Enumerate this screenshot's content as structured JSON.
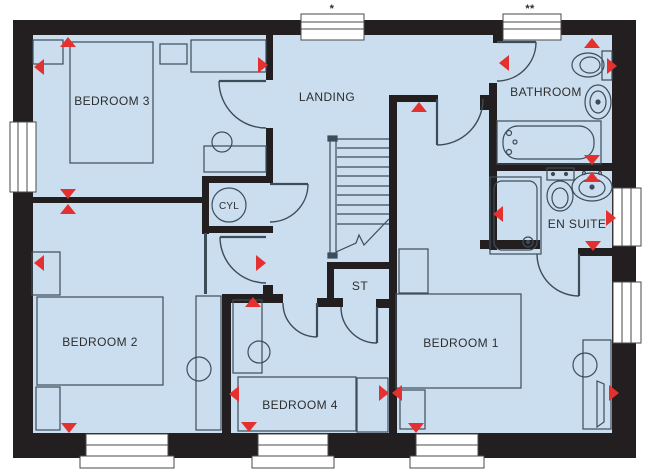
{
  "plan": {
    "title": "First floor plan",
    "rooms": {
      "bedroom3": "BEDROOM 3",
      "landing": "LANDING",
      "bathroom": "BATHROOM",
      "cyl": "CYL",
      "ensuite": "EN SUITE",
      "bedroom2": "BEDROOM 2",
      "st": "ST",
      "bedroom4": "BEDROOM 4",
      "bedroom1": "BEDROOM 1"
    },
    "window_notes": {
      "landing": "*",
      "bathroom": "**"
    },
    "colors": {
      "floor": "#cadeef",
      "wall": "#231f20",
      "marker": "#e53030",
      "line": "#3d4c59",
      "label": "#2d2d2d",
      "window_frame": "#4a4a4a"
    },
    "markers": [
      {
        "dir": "up",
        "x": 68,
        "y": 42
      },
      {
        "dir": "left",
        "x": 39,
        "y": 67
      },
      {
        "dir": "right",
        "x": 263,
        "y": 65
      },
      {
        "dir": "down",
        "x": 68,
        "y": 194
      },
      {
        "dir": "up",
        "x": 68,
        "y": 209
      },
      {
        "dir": "up",
        "x": 419,
        "y": 107
      },
      {
        "dir": "left",
        "x": 504,
        "y": 63
      },
      {
        "dir": "up",
        "x": 592,
        "y": 43
      },
      {
        "dir": "right",
        "x": 612,
        "y": 66
      },
      {
        "dir": "down",
        "x": 592,
        "y": 160
      },
      {
        "dir": "up",
        "x": 592,
        "y": 177
      },
      {
        "dir": "left",
        "x": 498,
        "y": 214
      },
      {
        "dir": "right",
        "x": 611,
        "y": 218
      },
      {
        "dir": "down",
        "x": 593,
        "y": 246
      },
      {
        "dir": "right",
        "x": 261,
        "y": 263
      },
      {
        "dir": "up",
        "x": 253,
        "y": 302
      },
      {
        "dir": "left",
        "x": 234,
        "y": 394
      },
      {
        "dir": "right",
        "x": 384,
        "y": 393
      },
      {
        "dir": "left",
        "x": 397,
        "y": 393
      },
      {
        "dir": "left",
        "x": 39,
        "y": 263
      },
      {
        "dir": "down",
        "x": 69,
        "y": 428
      },
      {
        "dir": "down",
        "x": 249,
        "y": 427
      },
      {
        "dir": "down",
        "x": 416,
        "y": 428
      },
      {
        "dir": "right",
        "x": 614,
        "y": 393
      }
    ]
  }
}
